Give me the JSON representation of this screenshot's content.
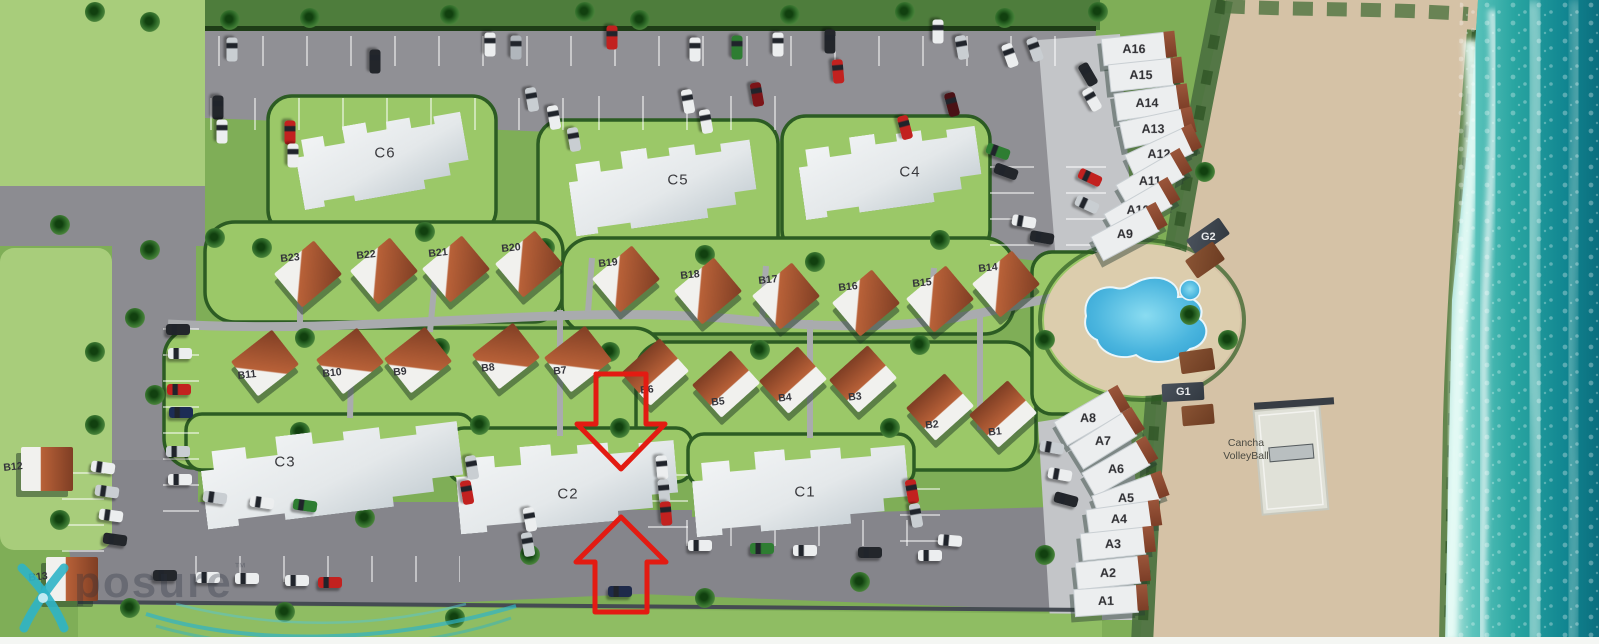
{
  "site": {
    "highlight": {
      "color": "#e31b12",
      "pointing_at": "C2"
    },
    "amenities": {
      "volleyball": {
        "line1": "Cancha",
        "line2": "VolleyBall"
      }
    },
    "watermark": {
      "text": "posure",
      "tm": "™"
    },
    "colors": {
      "grass_base": "#7fae57",
      "field_green": "#a8cd7b",
      "lawn_green": "#9bc868",
      "hedge_green": "#2c5c23",
      "road_gray": "#8c8c91",
      "concrete": "#c3c5c8",
      "sand": "#d5c2a6",
      "ocean_teal": "#29a5a1",
      "pool_blue": "#3fb2dd",
      "villa_roof": "#b86138",
      "building_white": "#eceeef",
      "arrow_red": "#e31b12",
      "watermark_teal": "#2fb4c6"
    },
    "buildings": {
      "condos": [
        {
          "id": "C6",
          "x": 382,
          "y": 158,
          "w": 170,
          "h": 76,
          "r": -10,
          "lx": 385,
          "ly": 153
        },
        {
          "id": "C5",
          "x": 662,
          "y": 185,
          "w": 185,
          "h": 78,
          "r": -8,
          "lx": 678,
          "ly": 180
        },
        {
          "id": "C4",
          "x": 890,
          "y": 170,
          "w": 180,
          "h": 76,
          "r": -8,
          "lx": 910,
          "ly": 172
        },
        {
          "id": "C3",
          "x": 332,
          "y": 472,
          "w": 260,
          "h": 84,
          "r": -7,
          "lx": 285,
          "ly": 462
        },
        {
          "id": "C2",
          "x": 567,
          "y": 484,
          "w": 220,
          "h": 82,
          "r": -5,
          "lx": 568,
          "ly": 494
        },
        {
          "id": "C1",
          "x": 800,
          "y": 488,
          "w": 215,
          "h": 80,
          "r": -5,
          "lx": 805,
          "ly": 492
        }
      ],
      "villas": [
        {
          "id": "B23",
          "lx": 290,
          "ly": 258,
          "dir": "se"
        },
        {
          "id": "B22",
          "lx": 366,
          "ly": 255,
          "dir": "se"
        },
        {
          "id": "B21",
          "lx": 438,
          "ly": 253,
          "dir": "se"
        },
        {
          "id": "B20",
          "lx": 511,
          "ly": 248,
          "dir": "se"
        },
        {
          "id": "B19",
          "lx": 608,
          "ly": 263,
          "dir": "se"
        },
        {
          "id": "B18",
          "lx": 690,
          "ly": 275,
          "dir": "se"
        },
        {
          "id": "B17",
          "lx": 768,
          "ly": 280,
          "dir": "se"
        },
        {
          "id": "B16",
          "lx": 848,
          "ly": 287,
          "dir": "se"
        },
        {
          "id": "B15",
          "lx": 922,
          "ly": 283,
          "dir": "se"
        },
        {
          "id": "B14",
          "lx": 988,
          "ly": 268,
          "dir": "se"
        },
        {
          "id": "B11",
          "lx": 247,
          "ly": 375,
          "dir": "ne"
        },
        {
          "id": "B10",
          "lx": 332,
          "ly": 373,
          "dir": "ne"
        },
        {
          "id": "B9",
          "lx": 400,
          "ly": 372,
          "dir": "ne"
        },
        {
          "id": "B8",
          "lx": 488,
          "ly": 368,
          "dir": "ne"
        },
        {
          "id": "B7",
          "lx": 560,
          "ly": 371,
          "dir": "ne"
        },
        {
          "id": "B6",
          "lx": 647,
          "ly": 390,
          "dir": "n"
        },
        {
          "id": "B5",
          "lx": 718,
          "ly": 402,
          "dir": "n"
        },
        {
          "id": "B4",
          "lx": 785,
          "ly": 398,
          "dir": "n"
        },
        {
          "id": "B3",
          "lx": 855,
          "ly": 397,
          "dir": "n"
        },
        {
          "id": "B2",
          "lx": 932,
          "ly": 425,
          "dir": "n"
        },
        {
          "id": "B1",
          "lx": 995,
          "ly": 432,
          "dir": "n"
        },
        {
          "id": "B12",
          "lx": 13,
          "ly": 467,
          "dir": "e"
        },
        {
          "id": "B13",
          "lx": 38,
          "ly": 577,
          "dir": "e"
        }
      ],
      "townhouses": [
        {
          "id": "A16",
          "x": 1133,
          "y": 48,
          "r": -6
        },
        {
          "id": "A15",
          "x": 1140,
          "y": 74,
          "r": -6
        },
        {
          "id": "A14",
          "x": 1146,
          "y": 102,
          "r": -8
        },
        {
          "id": "A13",
          "x": 1152,
          "y": 128,
          "r": -12
        },
        {
          "id": "A12",
          "x": 1158,
          "y": 153,
          "r": -25
        },
        {
          "id": "A11",
          "x": 1149,
          "y": 180,
          "r": -30
        },
        {
          "id": "A10",
          "x": 1137,
          "y": 209,
          "r": -30
        },
        {
          "id": "A9",
          "x": 1124,
          "y": 233,
          "r": -28
        },
        {
          "id": "A8",
          "x": 1087,
          "y": 417,
          "r": -30
        },
        {
          "id": "A7",
          "x": 1102,
          "y": 440,
          "r": -32
        },
        {
          "id": "A6",
          "x": 1115,
          "y": 468,
          "r": -30
        },
        {
          "id": "A5",
          "x": 1125,
          "y": 497,
          "r": -20
        },
        {
          "id": "A4",
          "x": 1118,
          "y": 518,
          "r": -8
        },
        {
          "id": "A3",
          "x": 1112,
          "y": 543,
          "r": -6
        },
        {
          "id": "A2",
          "x": 1107,
          "y": 572,
          "r": -6
        },
        {
          "id": "A1",
          "x": 1105,
          "y": 600,
          "r": -4
        }
      ],
      "garages": [
        {
          "id": "G2",
          "x": 1208,
          "y": 237,
          "w": 40,
          "h": 20,
          "r": -35
        },
        {
          "id": "G1",
          "x": 1183,
          "y": 392,
          "w": 42,
          "h": 18,
          "r": -3
        }
      ],
      "cabanas": [
        {
          "x": 1205,
          "y": 260,
          "w": 34,
          "h": 22,
          "r": -35
        },
        {
          "x": 1197,
          "y": 361,
          "w": 34,
          "h": 22,
          "r": -8
        },
        {
          "x": 1198,
          "y": 415,
          "w": 32,
          "h": 20,
          "r": -5
        }
      ]
    },
    "decor": {
      "cars": [
        [
          232,
          50,
          90,
          "#c9ced2"
        ],
        [
          375,
          62,
          90,
          "#23262b"
        ],
        [
          490,
          45,
          90,
          "#eceeef"
        ],
        [
          516,
          48,
          90,
          "#b0b6bc"
        ],
        [
          612,
          38,
          90,
          "#c2211f"
        ],
        [
          695,
          50,
          90,
          "#eceeef"
        ],
        [
          737,
          48,
          90,
          "#2e7d32"
        ],
        [
          778,
          45,
          90,
          "#eceeef"
        ],
        [
          830,
          42,
          90,
          "#23262b"
        ],
        [
          938,
          32,
          90,
          "#eceeef"
        ],
        [
          962,
          48,
          80,
          "#c9ced2"
        ],
        [
          1010,
          56,
          70,
          "#eceeef"
        ],
        [
          1035,
          50,
          70,
          "#c9ced2"
        ],
        [
          218,
          108,
          90,
          "#23262b"
        ],
        [
          222,
          132,
          90,
          "#eceeef"
        ],
        [
          290,
          133,
          90,
          "#c2211f"
        ],
        [
          293,
          156,
          90,
          "#eceeef"
        ],
        [
          532,
          100,
          80,
          "#c9ced2"
        ],
        [
          554,
          118,
          80,
          "#eceeef"
        ],
        [
          574,
          140,
          80,
          "#c9ced2"
        ],
        [
          688,
          102,
          80,
          "#eceeef"
        ],
        [
          706,
          122,
          80,
          "#eceeef"
        ],
        [
          757,
          95,
          80,
          "#7c1418"
        ],
        [
          838,
          72,
          85,
          "#c2211f"
        ],
        [
          905,
          128,
          75,
          "#c2211f"
        ],
        [
          952,
          105,
          75,
          "#4a1115"
        ],
        [
          1088,
          75,
          60,
          "#23262b"
        ],
        [
          1092,
          100,
          60,
          "#eceeef"
        ],
        [
          998,
          152,
          20,
          "#2e7d32"
        ],
        [
          1006,
          172,
          20,
          "#23262b"
        ],
        [
          1090,
          178,
          25,
          "#c2211f"
        ],
        [
          1087,
          205,
          25,
          "#c9ced2"
        ],
        [
          1024,
          222,
          10,
          "#eceeef"
        ],
        [
          1042,
          238,
          10,
          "#23262b"
        ],
        [
          178,
          330,
          0,
          "#23262b"
        ],
        [
          180,
          354,
          0,
          "#eceeef"
        ],
        [
          179,
          390,
          0,
          "#c2211f"
        ],
        [
          181,
          413,
          0,
          "#1d2c55"
        ],
        [
          178,
          452,
          0,
          "#c9ced2"
        ],
        [
          180,
          480,
          0,
          "#eceeef"
        ],
        [
          103,
          468,
          8,
          "#eceeef"
        ],
        [
          107,
          492,
          8,
          "#c9ced2"
        ],
        [
          111,
          516,
          8,
          "#eceeef"
        ],
        [
          115,
          540,
          8,
          "#23262b"
        ],
        [
          165,
          576,
          0,
          "#23262b"
        ],
        [
          208,
          578,
          0,
          "#eceeef"
        ],
        [
          247,
          579,
          0,
          "#eceeef"
        ],
        [
          297,
          581,
          0,
          "#eceeef"
        ],
        [
          330,
          583,
          0,
          "#c2211f"
        ],
        [
          215,
          498,
          8,
          "#c9ced2"
        ],
        [
          262,
          503,
          8,
          "#eceeef"
        ],
        [
          305,
          506,
          8,
          "#2e7d32"
        ],
        [
          472,
          468,
          80,
          "#c9ced2"
        ],
        [
          467,
          493,
          80,
          "#c2211f"
        ],
        [
          530,
          520,
          80,
          "#eceeef"
        ],
        [
          528,
          545,
          80,
          "#c9ced2"
        ],
        [
          662,
          468,
          85,
          "#eceeef"
        ],
        [
          664,
          492,
          85,
          "#c9ced2"
        ],
        [
          666,
          514,
          85,
          "#c2211f"
        ],
        [
          700,
          546,
          0,
          "#eceeef"
        ],
        [
          762,
          549,
          0,
          "#2e7d32"
        ],
        [
          805,
          551,
          0,
          "#eceeef"
        ],
        [
          912,
          492,
          80,
          "#c2211f"
        ],
        [
          916,
          516,
          80,
          "#c9ced2"
        ],
        [
          950,
          541,
          5,
          "#eceeef"
        ],
        [
          870,
          553,
          0,
          "#23262b"
        ],
        [
          930,
          556,
          0,
          "#eceeef"
        ],
        [
          1052,
          448,
          10,
          "#c9ced2"
        ],
        [
          1060,
          475,
          10,
          "#eceeef"
        ],
        [
          1066,
          500,
          15,
          "#23262b"
        ],
        [
          620,
          592,
          0,
          "#1e2a4a"
        ]
      ],
      "palms": [
        [
          95,
          12
        ],
        [
          150,
          22
        ],
        [
          230,
          20
        ],
        [
          310,
          18
        ],
        [
          450,
          15
        ],
        [
          585,
          12
        ],
        [
          640,
          20
        ],
        [
          790,
          15
        ],
        [
          905,
          12
        ],
        [
          1005,
          18
        ],
        [
          1098,
          12
        ],
        [
          215,
          238
        ],
        [
          262,
          248
        ],
        [
          150,
          250
        ],
        [
          60,
          225
        ],
        [
          135,
          318
        ],
        [
          95,
          352
        ],
        [
          155,
          395
        ],
        [
          95,
          425
        ],
        [
          60,
          520
        ],
        [
          305,
          338
        ],
        [
          440,
          348
        ],
        [
          610,
          352
        ],
        [
          760,
          350
        ],
        [
          920,
          345
        ],
        [
          1045,
          340
        ],
        [
          425,
          232
        ],
        [
          545,
          248
        ],
        [
          705,
          255
        ],
        [
          815,
          262
        ],
        [
          940,
          240
        ],
        [
          480,
          425
        ],
        [
          300,
          432
        ],
        [
          620,
          428
        ],
        [
          890,
          428
        ],
        [
          1010,
          425
        ],
        [
          130,
          608
        ],
        [
          285,
          612
        ],
        [
          455,
          618
        ],
        [
          705,
          598
        ],
        [
          860,
          582
        ],
        [
          1045,
          555
        ],
        [
          1175,
          92
        ],
        [
          1205,
          172
        ],
        [
          1190,
          315
        ],
        [
          1228,
          340
        ],
        [
          365,
          518
        ],
        [
          530,
          555
        ]
      ]
    }
  }
}
